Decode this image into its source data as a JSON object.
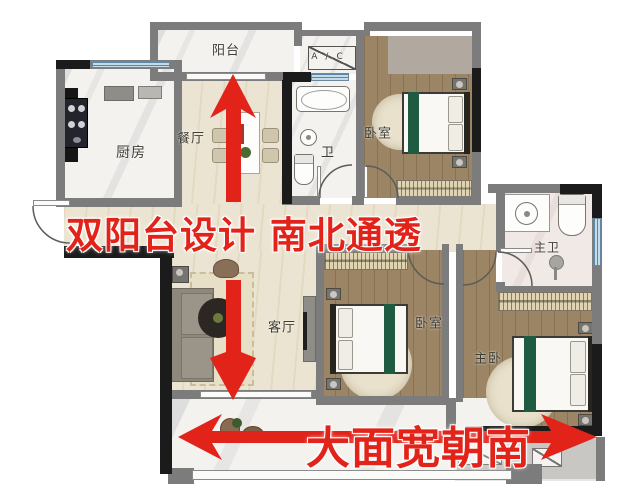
{
  "rooms": {
    "balcony_top": {
      "label": "阳台"
    },
    "ac": {
      "label": "A/C"
    },
    "kitchen": {
      "label": "厨房"
    },
    "dining": {
      "label": "餐厅"
    },
    "bath": {
      "label": "卫"
    },
    "bedroom_top": {
      "label": "卧室"
    },
    "master_bath": {
      "label": "主卫"
    },
    "bedroom_mid": {
      "label": "卧室"
    },
    "master_bedroom": {
      "label": "主卧"
    },
    "living": {
      "label": "客厅"
    },
    "balcony_bottom": {
      "label": "阳台"
    }
  },
  "annotations": {
    "banner_north_south": "双阳台设计 南北通透",
    "banner_south_width": "大面宽朝南",
    "arrow_icons": [
      "up-arrow-icon",
      "down-arrow-icon",
      "left-right-arrow-icon"
    ]
  },
  "colors": {
    "annotation_red": "#e2231a",
    "wall_gray": "#7c7c7c",
    "wall_black": "#1b1b1b",
    "window_blue": "#c4dcea",
    "floor_cream": "#ece4d2",
    "floor_wood": "#9c8565",
    "wardrobe_tan": "#dfd3b2",
    "bed_runner_green": "#1e5b40"
  }
}
